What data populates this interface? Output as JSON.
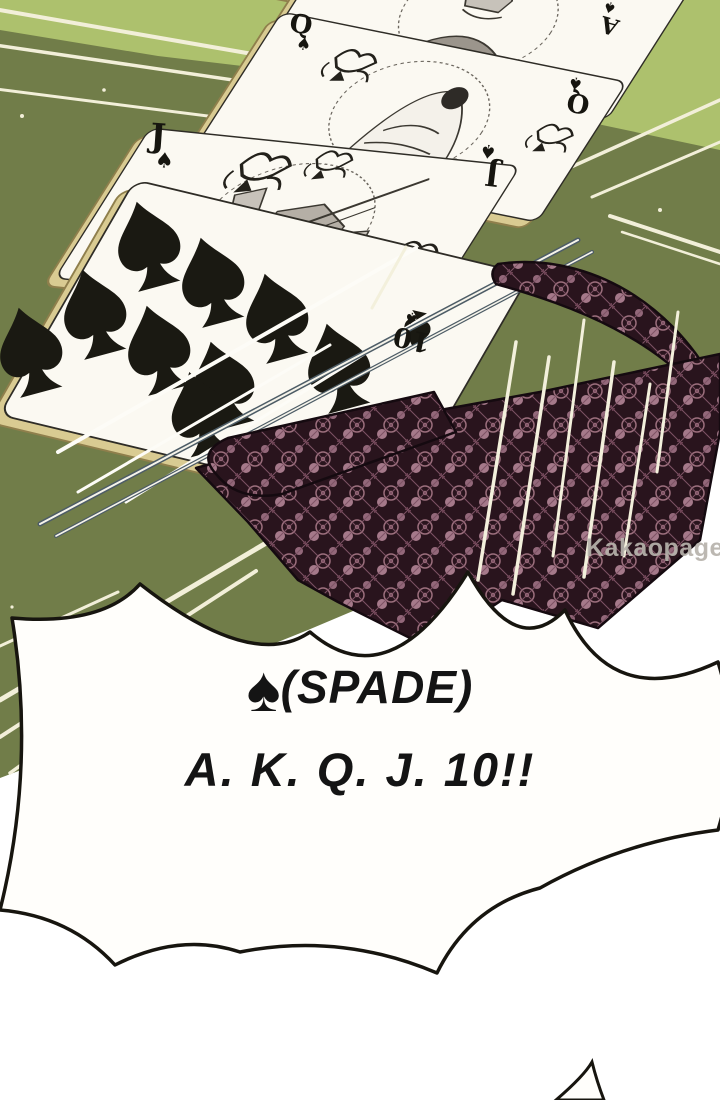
{
  "cards": {
    "suit": "spade",
    "suit_symbol": "♠",
    "ranks": {
      "ace": "A",
      "king": "K",
      "queen": "Q",
      "jack": "J",
      "ten": "10"
    }
  },
  "speech_bubble": {
    "suit_icon": "♠",
    "line1": "(SPADE)",
    "line2": "A. K. Q. J. 10!!"
  },
  "watermark": {
    "brand": "Kakaopage",
    "domain": ".co.id"
  },
  "colors": {
    "table_green_dark": "#717d49",
    "table_green_light": "#adc16d",
    "card_white": "#fbf9f2",
    "card_edge_tan": "#d9cb92",
    "lace_dark": "#29141d",
    "lace_mauve": "#a17787",
    "pink_card": "#e9ced5",
    "speedline_cream": "#f2efd9",
    "ink_black": "#16150f",
    "watermark_gray": "#b7b3ac"
  }
}
